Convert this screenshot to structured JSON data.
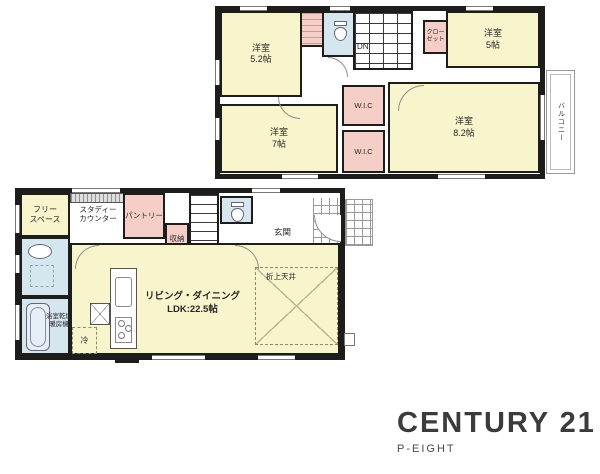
{
  "f2": {
    "room_a": {
      "l1": "洋室",
      "l2": "5.2帖"
    },
    "room_b": {
      "l1": "洋室",
      "l2": "5帖"
    },
    "room_c": {
      "l1": "洋室",
      "l2": "7帖"
    },
    "room_d": {
      "l1": "洋室",
      "l2": "8.2帖"
    },
    "closet": {
      "l1": "クロー",
      "l2": "ゼット"
    },
    "wic_a": "W.I.C",
    "wic_b": "W.I.C",
    "dn": "DN",
    "balcony": "バルコニー"
  },
  "f1": {
    "free": {
      "l1": "フリー",
      "l2": "スペース"
    },
    "study": {
      "l1": "スタディー",
      "l2": "カウンター"
    },
    "pantry": "パントリー",
    "storage": "収納",
    "storage_mark": "∨",
    "up": "UP",
    "entrance": "玄関",
    "living": {
      "l1": "リビング・ダイニング",
      "l2": "LDK:22.5帖"
    },
    "ceiling": "折上天井",
    "bath": {
      "l1": "浴室乾燥",
      "l2": "暖房機"
    },
    "fridge": "冷"
  },
  "logo": {
    "brand": "CENTURY 21",
    "office": "P-EIGHT"
  },
  "colors": {
    "room_yellow": "#F8F5CD",
    "closet_pink": "#F4CEC7",
    "sanitary_blue": "#D6E6EF",
    "wall_black": "#1D1D1B",
    "logo_gray": "#3B3B3B"
  }
}
